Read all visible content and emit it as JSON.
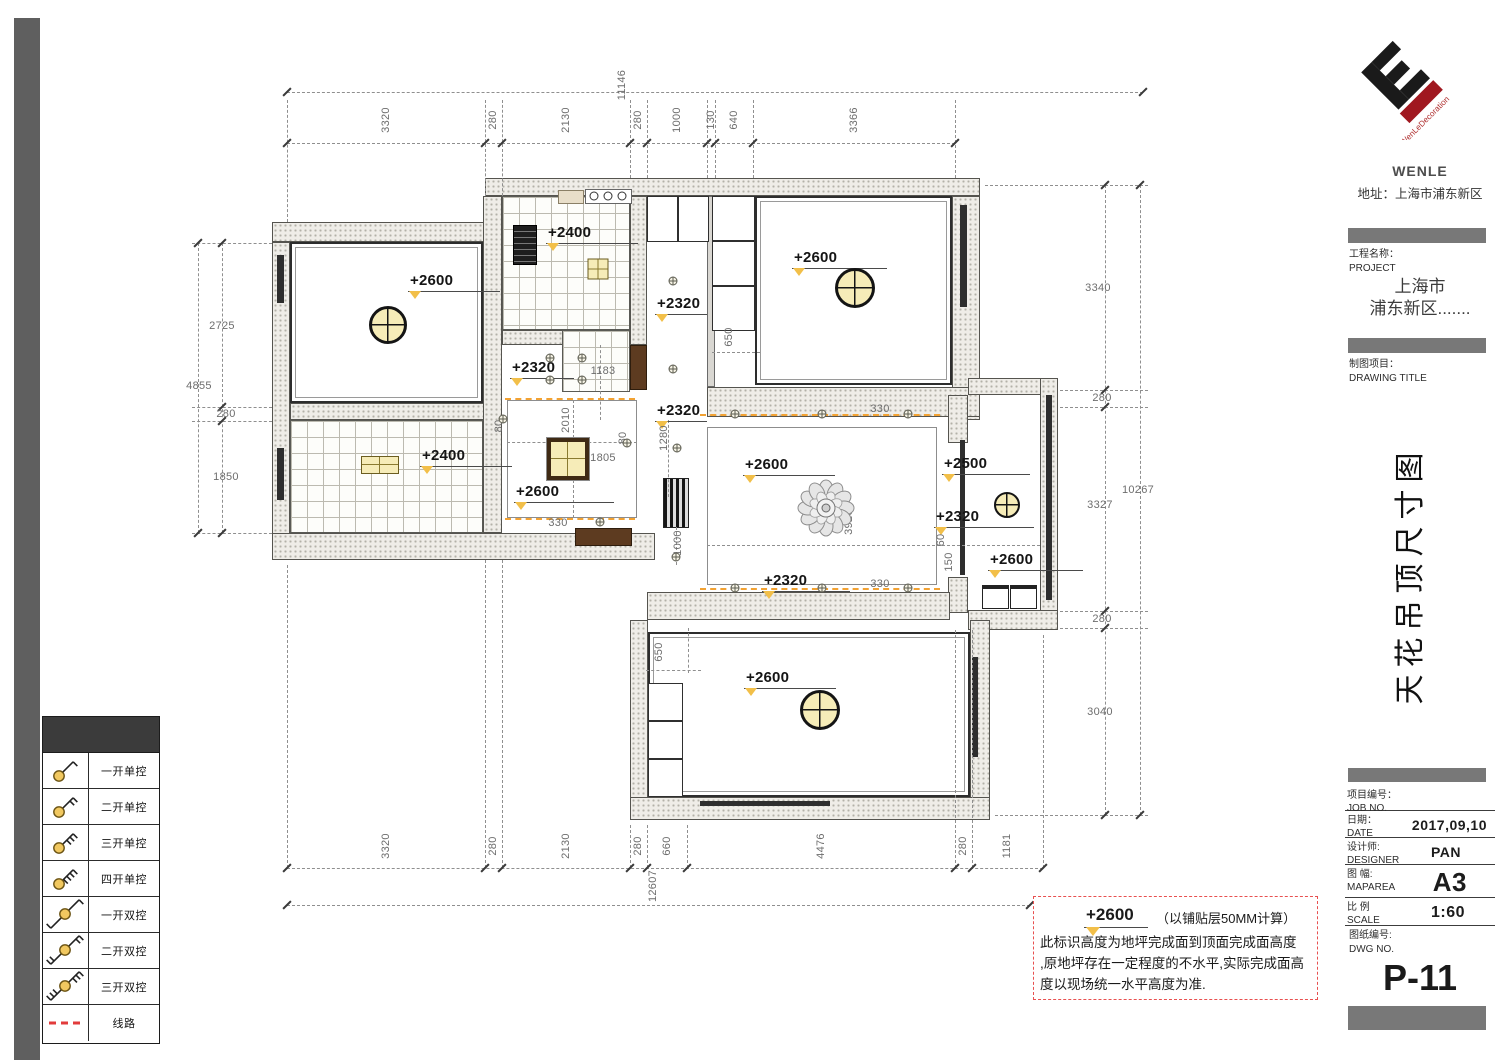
{
  "title_block": {
    "logo_text": "WenLeDecoration",
    "company": "WENLE",
    "address": "地址：上海市浦东新区",
    "project_label_cn": "工程名称：",
    "project_label_en": "PROJECT",
    "project_line1": "上海市",
    "project_line2": "浦东新区.......",
    "drawing_label_cn": "制图项目：",
    "drawing_label_en": "DRAWING TITLE",
    "drawing_title_vertical": "天花吊顶尺寸图",
    "job_no_cn": "项目编号：",
    "job_no_en": "JOB NO.",
    "date_cn": "日期：",
    "date_en": "DATE",
    "date_value": "2017,09,10",
    "designer_cn": "设计师:",
    "designer_en": "DESIGNER",
    "designer_value": "PAN",
    "maparea_cn": "图 幅:",
    "maparea_en": "MAPAREA",
    "maparea_value": "A3",
    "scale_cn": "比 例",
    "scale_en": "SCALE",
    "scale_value": "1:60",
    "dwg_cn": "图纸编号:",
    "dwg_en": "DWG NO.",
    "dwg_value": "P-11"
  },
  "legend": {
    "rows": [
      {
        "symbol": "switch-1-single",
        "ticks": 1,
        "double": false,
        "label": "一开单控"
      },
      {
        "symbol": "switch-2-single",
        "ticks": 2,
        "double": false,
        "label": "二开单控"
      },
      {
        "symbol": "switch-3-single",
        "ticks": 3,
        "double": false,
        "label": "三开单控"
      },
      {
        "symbol": "switch-4-single",
        "ticks": 4,
        "double": false,
        "label": "四开单控"
      },
      {
        "symbol": "switch-1-double",
        "ticks": 1,
        "double": true,
        "label": "一开双控"
      },
      {
        "symbol": "switch-2-double",
        "ticks": 2,
        "double": true,
        "label": "二开双控"
      },
      {
        "symbol": "switch-3-double",
        "ticks": 3,
        "double": true,
        "label": "三开双控"
      },
      {
        "symbol": "wire-line",
        "type": "line",
        "label": "线路"
      }
    ]
  },
  "note_box": {
    "height": "+2600",
    "height_note": "（以铺贴层50MM计算）",
    "lines": [
      "此标识高度为地坪完成面到顶面完成面高度",
      ",原地坪存在一定程度的不水平,实际完成面高",
      "度以现场统一水平高度为准."
    ]
  },
  "plan": {
    "height_labels": [
      {
        "t": "+2600",
        "x": 408,
        "y": 272,
        "w": 92
      },
      {
        "t": "+2400",
        "x": 546,
        "y": 224,
        "w": 92
      },
      {
        "t": "+2600",
        "x": 792,
        "y": 249,
        "w": 95
      },
      {
        "t": "+2320",
        "x": 655,
        "y": 295,
        "w": 52
      },
      {
        "t": "+2320",
        "x": 655,
        "y": 402,
        "w": 52
      },
      {
        "t": "+2320",
        "x": 510,
        "y": 359,
        "w": 64
      },
      {
        "t": "+2400",
        "x": 420,
        "y": 447,
        "w": 92
      },
      {
        "t": "+2600",
        "x": 514,
        "y": 483,
        "w": 100
      },
      {
        "t": "+2600",
        "x": 743,
        "y": 456,
        "w": 92
      },
      {
        "t": "+2320",
        "x": 762,
        "y": 572,
        "w": 88
      },
      {
        "t": "+2500",
        "x": 942,
        "y": 455,
        "w": 88
      },
      {
        "t": "+2320",
        "x": 934,
        "y": 508,
        "w": 100
      },
      {
        "t": "+2600",
        "x": 988,
        "y": 551,
        "w": 95
      },
      {
        "t": "+2600",
        "x": 744,
        "y": 669,
        "w": 92
      }
    ],
    "dim_labels": [
      {
        "t": "3320",
        "x": 386,
        "y": 120,
        "r": 1
      },
      {
        "t": "280",
        "x": 493,
        "y": 120,
        "r": 1
      },
      {
        "t": "2130",
        "x": 566,
        "y": 120,
        "r": 1
      },
      {
        "t": "280",
        "x": 638,
        "y": 120,
        "r": 1
      },
      {
        "t": "1000",
        "x": 677,
        "y": 120,
        "r": 1
      },
      {
        "t": "130",
        "x": 711,
        "y": 120,
        "r": 1
      },
      {
        "t": "640",
        "x": 734,
        "y": 120,
        "r": 1
      },
      {
        "t": "3366",
        "x": 854,
        "y": 120,
        "r": 1
      },
      {
        "t": "11146",
        "x": 622,
        "y": 85,
        "r": 1
      },
      {
        "t": "3320",
        "x": 386,
        "y": 846,
        "r": 1
      },
      {
        "t": "280",
        "x": 493,
        "y": 846,
        "r": 1
      },
      {
        "t": "2130",
        "x": 566,
        "y": 846,
        "r": 1
      },
      {
        "t": "280",
        "x": 638,
        "y": 846,
        "r": 1
      },
      {
        "t": "660",
        "x": 667,
        "y": 846,
        "r": 1
      },
      {
        "t": "4476",
        "x": 821,
        "y": 846,
        "r": 1
      },
      {
        "t": "280",
        "x": 963,
        "y": 846,
        "r": 1
      },
      {
        "t": "1181",
        "x": 1007,
        "y": 846,
        "r": 1
      },
      {
        "t": "12607",
        "x": 653,
        "y": 886,
        "r": 1
      },
      {
        "t": "2725",
        "x": 222,
        "y": 326,
        "r": 0
      },
      {
        "t": "280",
        "x": 226,
        "y": 414,
        "r": 0
      },
      {
        "t": "1850",
        "x": 226,
        "y": 477,
        "r": 0
      },
      {
        "t": "4855",
        "x": 199,
        "y": 386,
        "r": 0
      },
      {
        "t": "3340",
        "x": 1098,
        "y": 288,
        "r": 0
      },
      {
        "t": "280",
        "x": 1102,
        "y": 398,
        "r": 0
      },
      {
        "t": "3327",
        "x": 1100,
        "y": 505,
        "r": 0
      },
      {
        "t": "280",
        "x": 1102,
        "y": 619,
        "r": 0
      },
      {
        "t": "3040",
        "x": 1100,
        "y": 712,
        "r": 0
      },
      {
        "t": "10267",
        "x": 1138,
        "y": 490,
        "r": 0
      },
      {
        "t": "1183",
        "x": 603,
        "y": 371,
        "r": 0
      },
      {
        "t": "2010",
        "x": 566,
        "y": 420,
        "r": 1
      },
      {
        "t": "1805",
        "x": 603,
        "y": 458,
        "r": 0
      },
      {
        "t": "330",
        "x": 558,
        "y": 523,
        "r": 0
      },
      {
        "t": "330",
        "x": 880,
        "y": 409,
        "r": 0
      },
      {
        "t": "330",
        "x": 880,
        "y": 584,
        "r": 0
      },
      {
        "t": "3926",
        "x": 849,
        "y": 522,
        "r": 1
      },
      {
        "t": "1280",
        "x": 664,
        "y": 438,
        "r": 1
      },
      {
        "t": "1000",
        "x": 678,
        "y": 543,
        "r": 1
      },
      {
        "t": "650",
        "x": 729,
        "y": 337,
        "r": 1
      },
      {
        "t": "650",
        "x": 659,
        "y": 652,
        "r": 1
      },
      {
        "t": "60",
        "x": 941,
        "y": 540,
        "r": 1
      },
      {
        "t": "150",
        "x": 949,
        "y": 562,
        "r": 1
      },
      {
        "t": "80",
        "x": 499,
        "y": 426,
        "r": 1
      },
      {
        "t": "80",
        "x": 623,
        "y": 438,
        "r": 1
      }
    ],
    "round_lamps": [
      {
        "x": 388,
        "y": 325,
        "r": 19
      },
      {
        "x": 855,
        "y": 288,
        "r": 20
      },
      {
        "x": 820,
        "y": 710,
        "r": 20
      },
      {
        "x": 1007,
        "y": 505,
        "r": 13
      }
    ],
    "square_lamps": [
      {
        "x": 598,
        "y": 269,
        "w": 21,
        "h": 21,
        "big": false
      },
      {
        "x": 380,
        "y": 465,
        "w": 38,
        "h": 18,
        "big": false
      },
      {
        "x": 568,
        "y": 459,
        "w": 42,
        "h": 42,
        "big": true
      }
    ],
    "chandelier": {
      "x": 823,
      "y": 505,
      "r": 27
    },
    "spotlights": [
      [
        550,
        358
      ],
      [
        582,
        358
      ],
      [
        550,
        380
      ],
      [
        582,
        380
      ],
      [
        673,
        281
      ],
      [
        673,
        369
      ],
      [
        735,
        414
      ],
      [
        822,
        414
      ],
      [
        908,
        414
      ],
      [
        735,
        588
      ],
      [
        822,
        588
      ],
      [
        908,
        588
      ],
      [
        600,
        522
      ],
      [
        677,
        448
      ],
      [
        676,
        557
      ],
      [
        503,
        419
      ],
      [
        627,
        443
      ]
    ],
    "colors": {
      "lamp_fill": "#f6ecb8",
      "marker_yellow": "#f2bf49",
      "orange_dash": "#f2a233",
      "red_dash": "#e85050",
      "wall_dot": "#b3b1a8"
    }
  }
}
